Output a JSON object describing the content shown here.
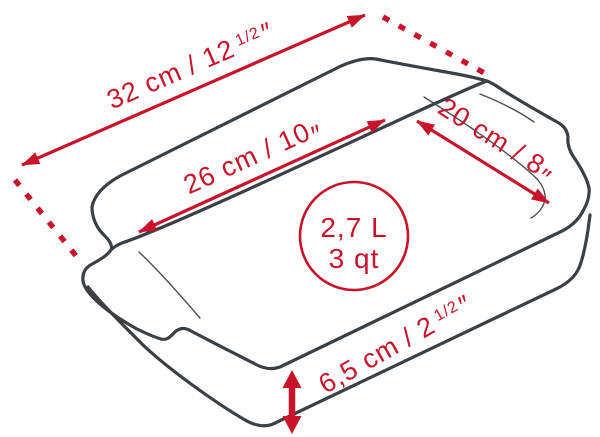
{
  "figure": {
    "kind": "product-dimension-diagram",
    "subject": "rectangular-baking-dish",
    "accent_color": "#c9132b",
    "line_color": "#3b4045",
    "background_color": "#ffffff"
  },
  "dimensions": {
    "outer_length": {
      "value": "32 cm / 12",
      "fraction": "1/2",
      "unit_mark": "″"
    },
    "inner_length": {
      "value": "26 cm / 10",
      "fraction": "",
      "unit_mark": "″"
    },
    "inner_width": {
      "value": "20 cm / 8",
      "fraction": "",
      "unit_mark": "″"
    },
    "height": {
      "value": "6,5 cm / 2",
      "fraction": "1/2",
      "unit_mark": "″"
    },
    "capacity": {
      "line1": "2,7 L",
      "line2": "3 qt"
    }
  }
}
